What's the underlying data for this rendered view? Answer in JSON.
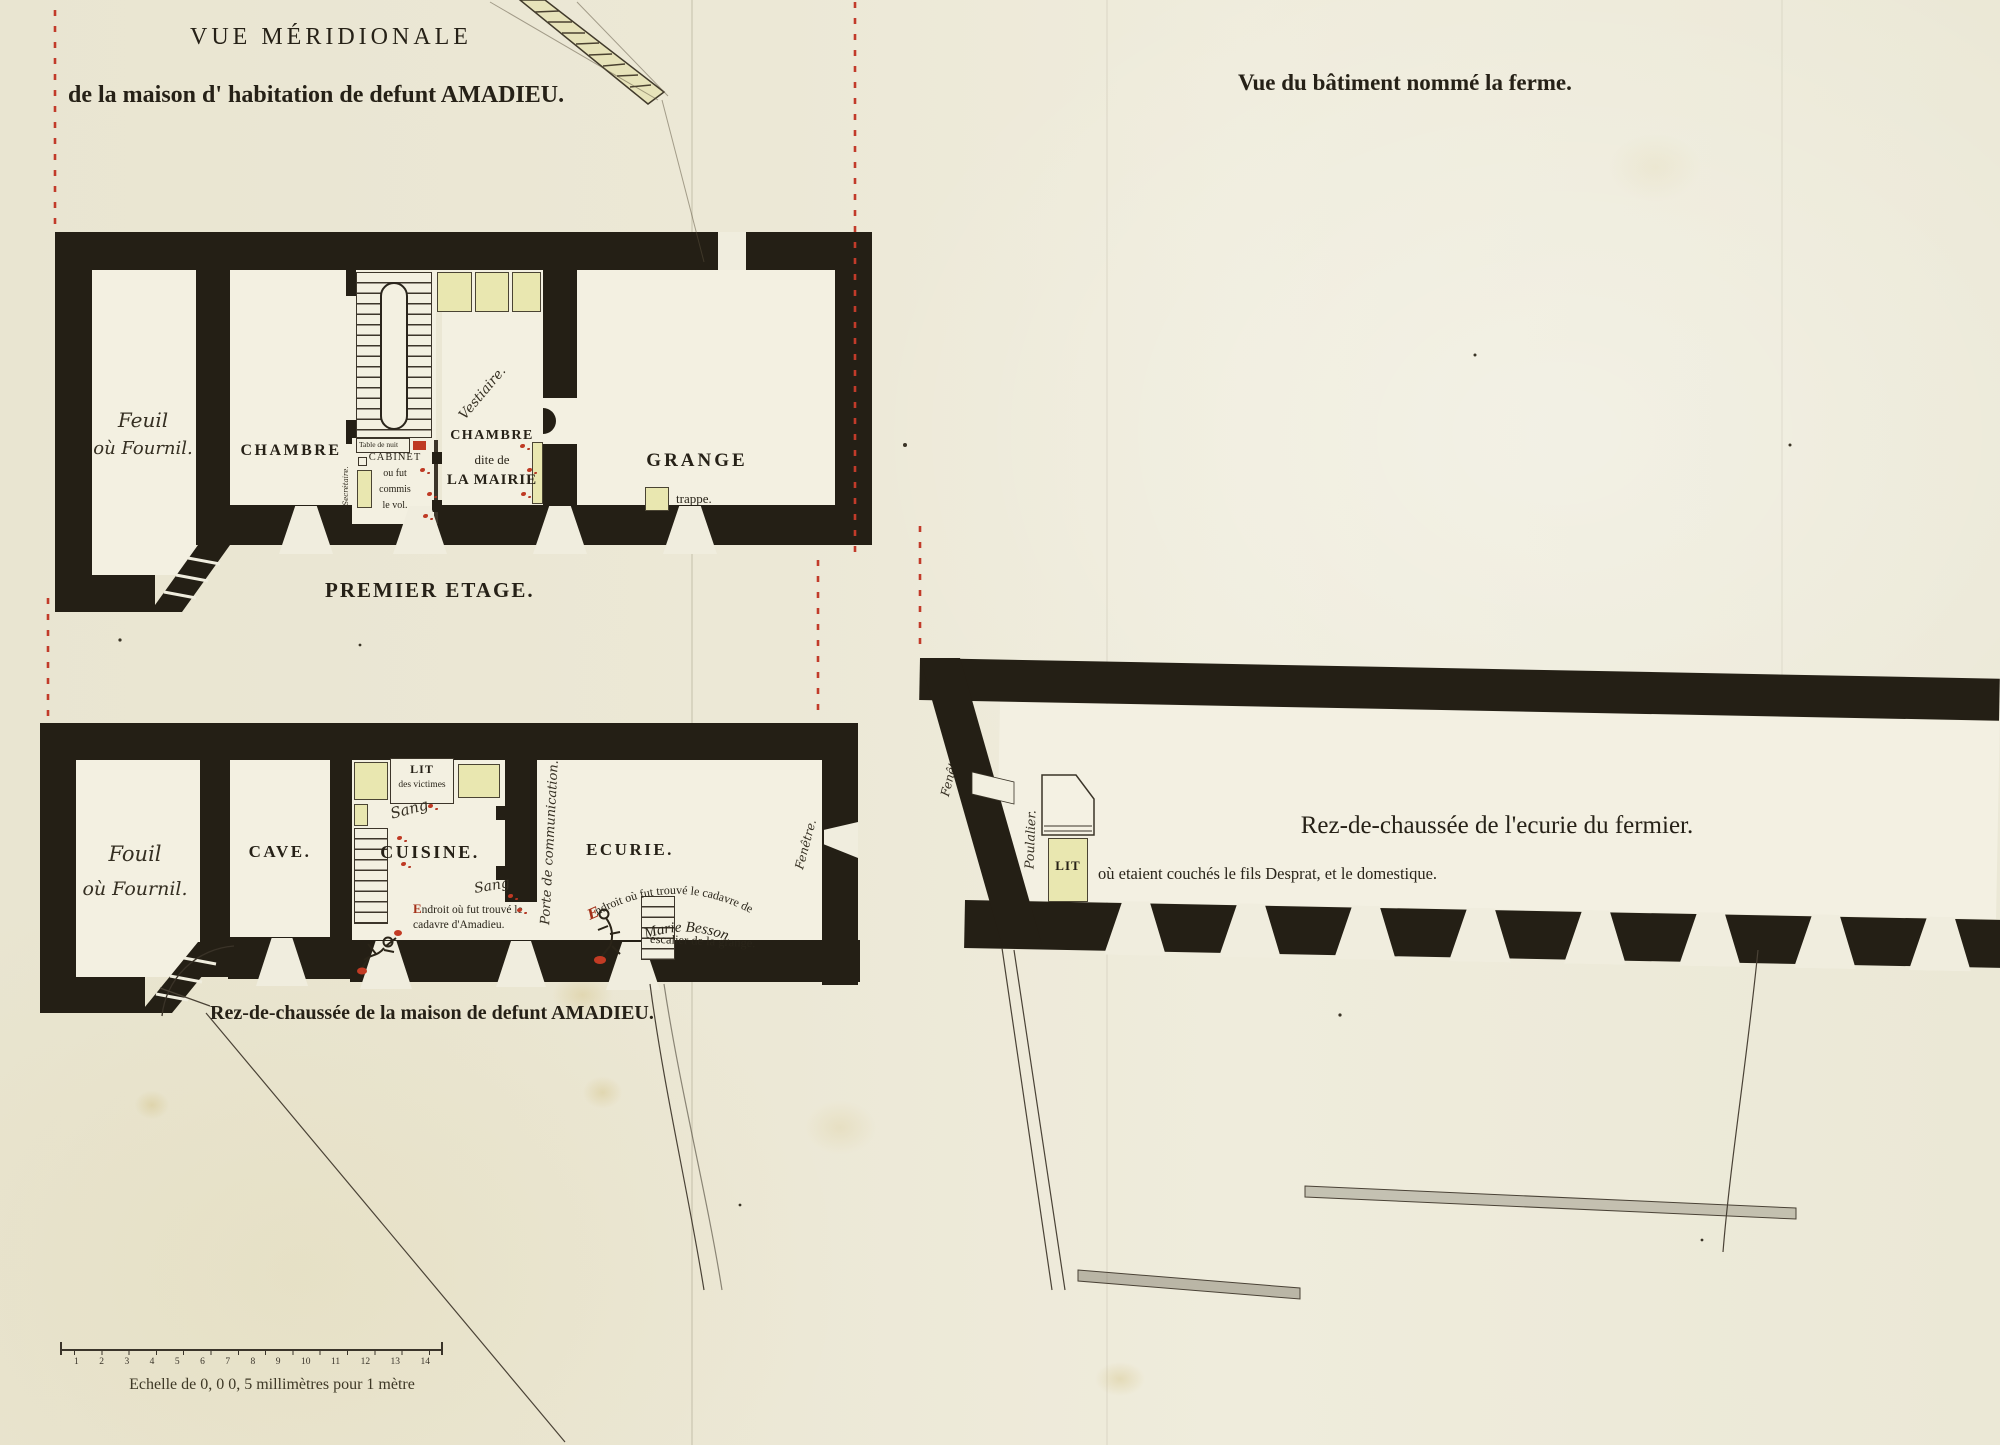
{
  "colors": {
    "paper": "#ece8d6",
    "wall_ink": "#241f15",
    "accent_red": "#bf3a24",
    "furniture_yellow": "#e9e7b0"
  },
  "header": {
    "title_line1": "VUE MÉRIDIONALE",
    "title_line2": "de la maison d' habitation de defunt AMADIEU.",
    "right_title": "Vue du bâtiment nommé la ferme."
  },
  "first_floor": {
    "caption": "PREMIER ETAGE.",
    "room_fenil_line1": "Feuil",
    "room_fenil_line2": "où Fournil.",
    "room_chambre": "CHAMBRE",
    "table_de_nuit": "Table de nuit",
    "secretaire": "Secrétaire.",
    "cabinet_line1": "CABINET",
    "cabinet_line2": "ou fut",
    "cabinet_line3": "commis",
    "cabinet_line4": "le vol.",
    "vestiaire": "Vestiaire.",
    "mairie_line1": "CHAMBRE",
    "mairie_line2": "dite de",
    "mairie_line3": "LA MAIRIE",
    "room_grange": "GRANGE",
    "trappe": "trappe."
  },
  "ground_floor": {
    "caption": "Rez-de-chaussée de la maison de defunt AMADIEU.",
    "room_fouil_line1": "Fouil",
    "room_fouil_line2": "où Fournil.",
    "room_cave": "CAVE.",
    "lit_line1": "LIT",
    "lit_line2": "des victimes",
    "sang1": "Sang",
    "sang2": "Sang",
    "room_cuisine": "CUISINE.",
    "amadieu_initial": "E",
    "amadieu_line1_rest": "ndroit où fut trouvé le",
    "amadieu_line2": "cadavre d'Amadieu.",
    "porte_comm": "Porte de communication.",
    "room_ecurie": "ECURIE.",
    "besson_initial": "E",
    "besson_arc": "ndroit où fut trouvé le cadavre de",
    "besson_name": "Marie Besson.",
    "escalier": "escalier de la grange.",
    "fenetre": "Fenêtre."
  },
  "farm": {
    "title": "Rez-de-chaussée de l'ecurie du fermier.",
    "subtitle": "où etaient couchés le fils Desprat, et le domestique.",
    "fenetre": "Fenêtre.",
    "poulailler": "Poulalier.",
    "lit": "LIT"
  },
  "scale_bar": {
    "ticks": [
      "1",
      "2",
      "3",
      "4",
      "5",
      "6",
      "7",
      "8",
      "9",
      "10",
      "11",
      "12",
      "13",
      "14"
    ],
    "caption": "Echelle de 0, 0 0, 5 millimètres pour 1 mètre"
  }
}
